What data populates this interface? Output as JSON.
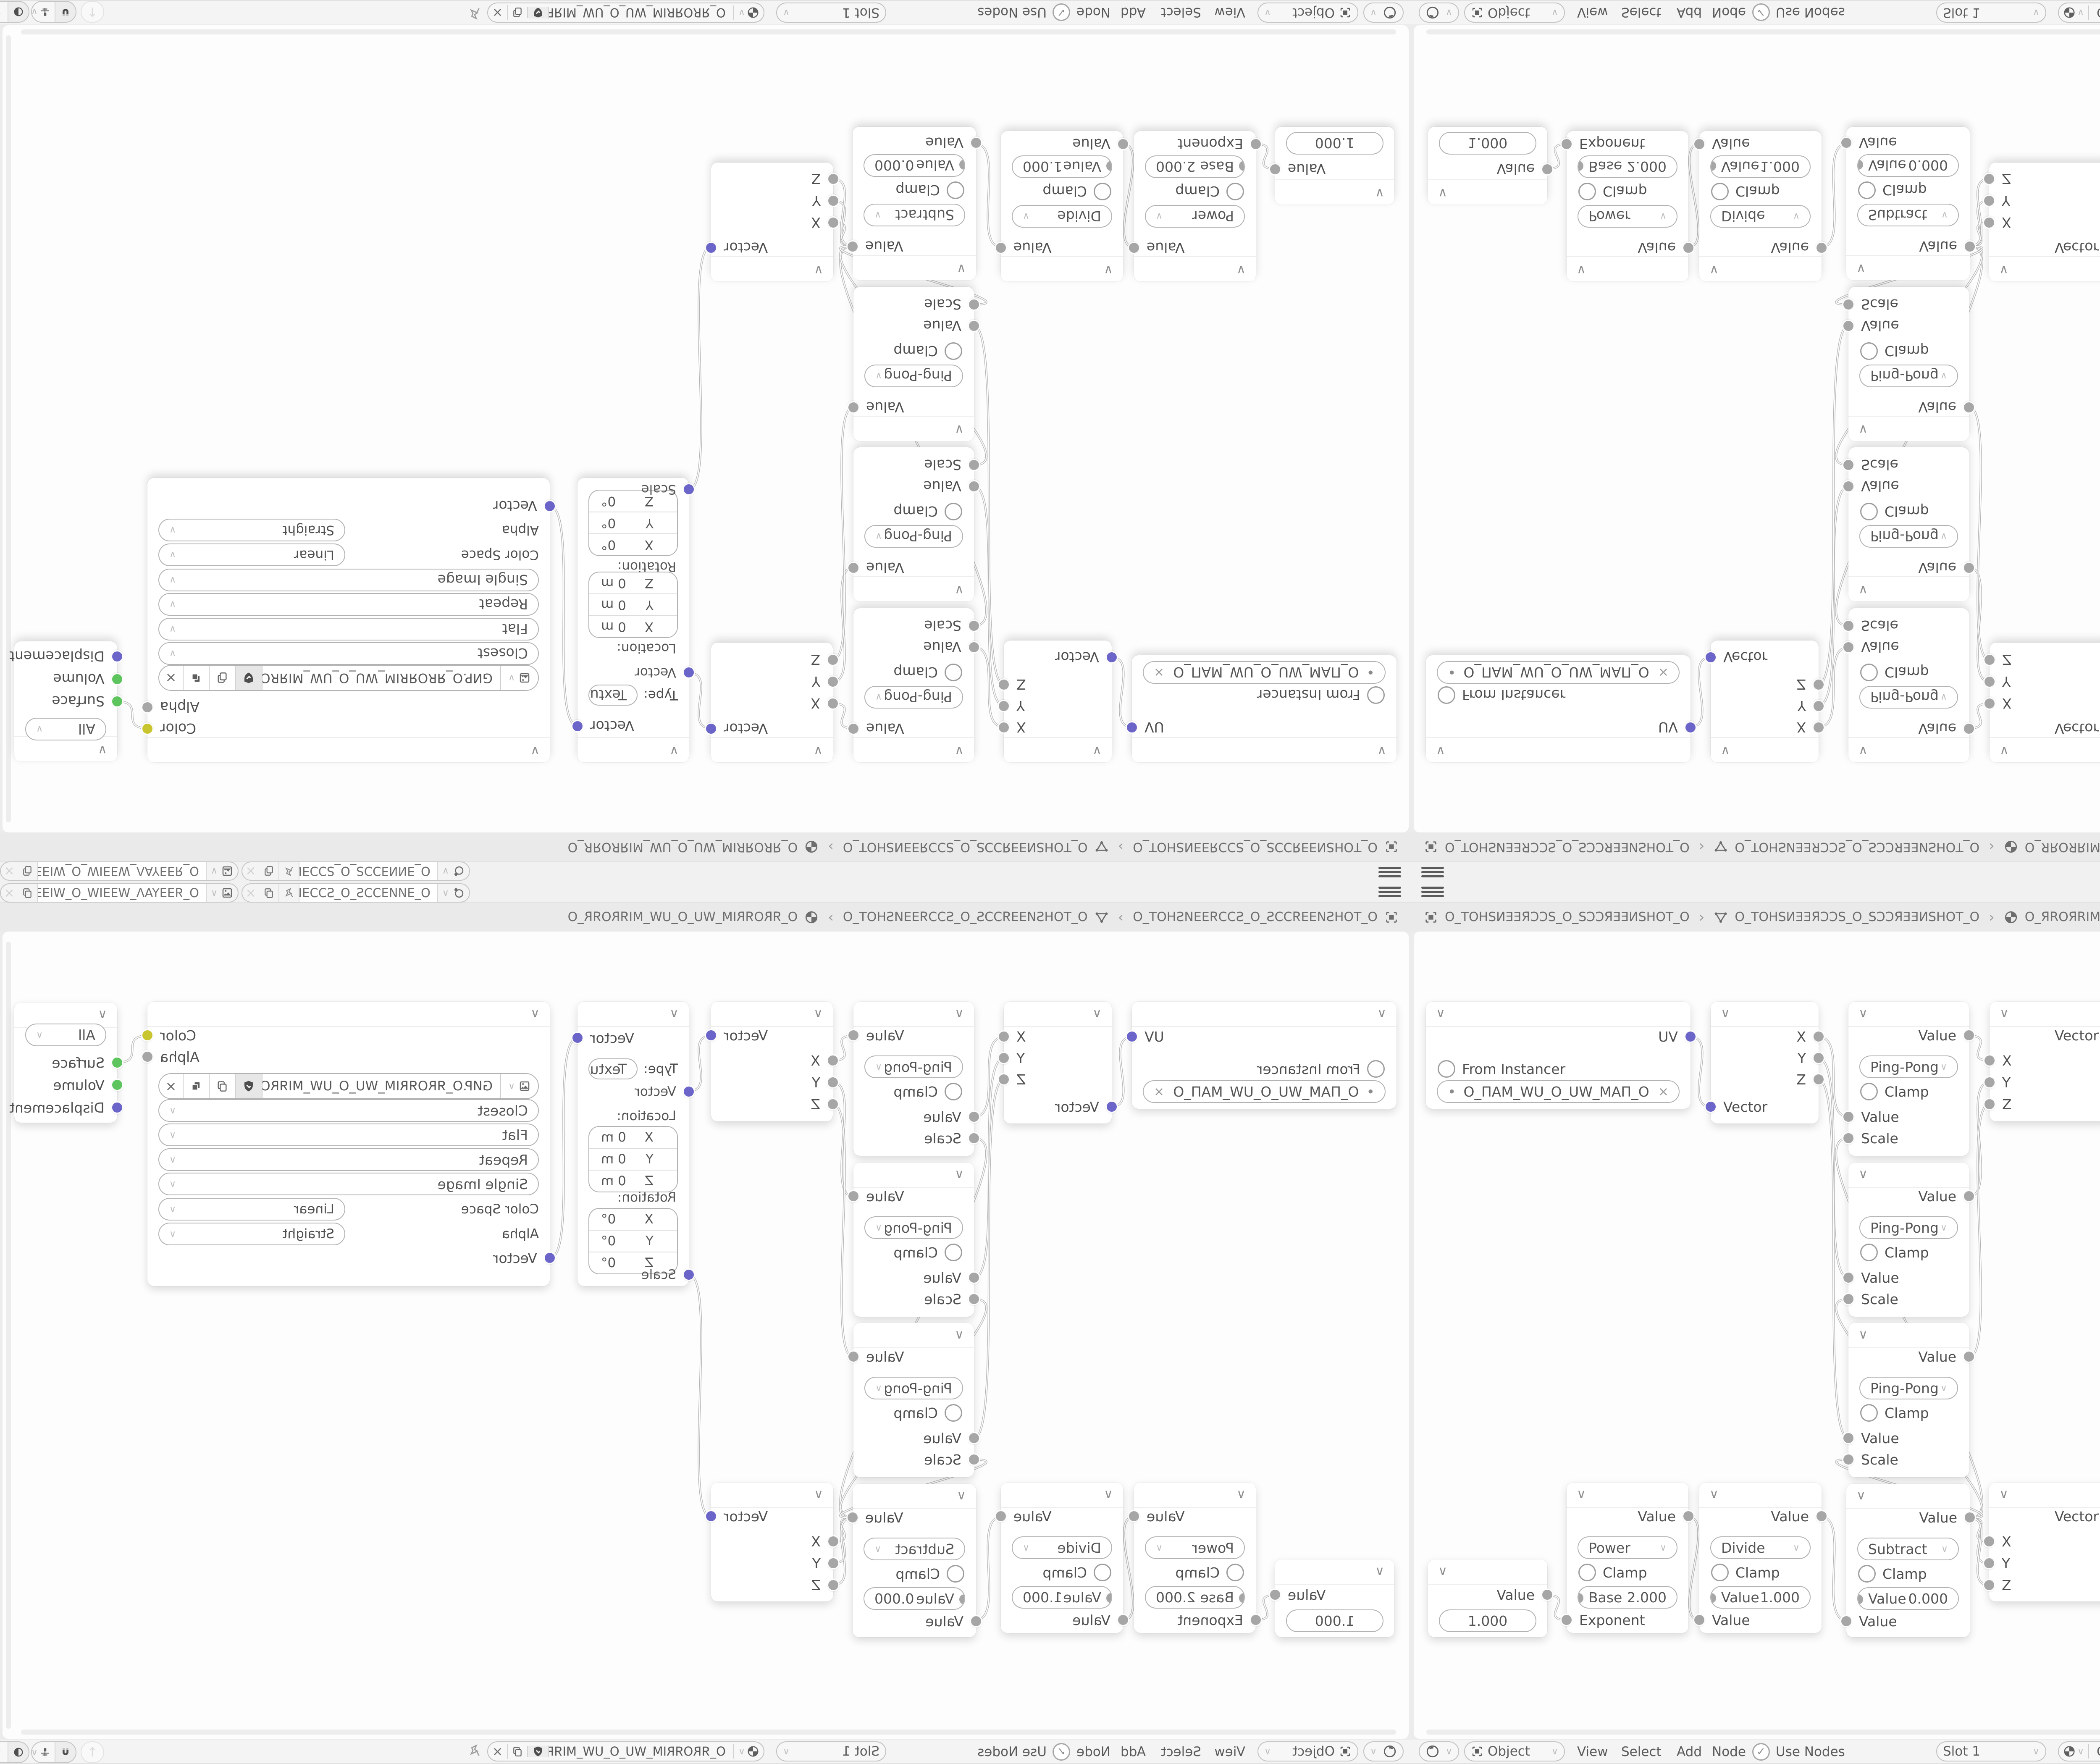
{
  "icons": {
    "chevron": "∨",
    "dropdown": "∨",
    "separator": "›",
    "close": "×",
    "check": "✓",
    "dot": "•",
    "up_arrow": "↑"
  },
  "topbar": {
    "scene_field": "O_ƎИИƎƆƆS_O_SƆƆƎИ...",
    "viewlayer_field": "O_ЯƎƎYAΛ_WƎƎIW_O_WIƎƎW_ΛAYƎƎЯ_O"
  },
  "breadcrumb": {
    "scene": "O_TOHSИƎƎЯƆƆS_O_SƆƆЯƎƎИSHOT_O",
    "object": "O_TOHSИƎƎЯƆƆS_O_SƆƆЯƎƎИSHOT_O",
    "material": "O_ЯROЯRIM_WU_O_UW_MIЯROЯR_O"
  },
  "nodes": {
    "uvmap": {
      "uv": "UV",
      "from_instancer": "From Instancer",
      "map_name": "O_ПAM_WU_O_UW_MAП_O"
    },
    "separate": {
      "x": "X",
      "y": "Y",
      "z": "Z",
      "vector": "Vector"
    },
    "pingpong": {
      "value": "Value",
      "op": "Ping-Pong",
      "clamp": "Clamp",
      "value_in": "Value",
      "scale": "Scale"
    },
    "combine": {
      "vector": "Vector",
      "x": "X",
      "y": "Y",
      "z": "Z"
    },
    "mapping": {
      "vector": "Vector",
      "type": "Type:",
      "type_value": "Texture",
      "vector_in": "Vector",
      "location": "Location:",
      "rotation": "Rotation:",
      "x": "X",
      "y": "Y",
      "z": "Z",
      "meters": "0 m",
      "degrees": "0°",
      "scale": "Scale"
    },
    "image_texture": {
      "color": "Color",
      "alpha": "Alpha",
      "file": "GИP.O_ЯROЯRIM_WU_O_UW_MIЯROЯR_O.PNG",
      "interpolation": "Closest",
      "projection": "Flat",
      "extension": "Repeat",
      "source": "Single Image",
      "color_space": "Color Space",
      "color_space_value": "Linear",
      "alpha_label": "Alpha",
      "alpha_value": "Straight",
      "vector": "Vector"
    },
    "output": {
      "target": "All",
      "surface": "Surface",
      "volume": "Volume",
      "displacement": "Displacement"
    },
    "value_node": {
      "value": "Value",
      "number": "1.000"
    },
    "power": {
      "value": "Value",
      "op": "Power",
      "clamp": "Clamp",
      "field_label": "Base",
      "field_value": "2.000",
      "input": "Exponent"
    },
    "divide": {
      "value": "Value",
      "op": "Divide",
      "clamp": "Clamp",
      "field_label": "Value",
      "field_value": "1.000",
      "input": "Value"
    },
    "subtract": {
      "value": "Value",
      "op": "Subtract",
      "clamp": "Clamp",
      "field_label": "Value",
      "field_value": "0.000",
      "input": "Value"
    }
  },
  "header": {
    "mode": "Object",
    "view": "View",
    "select": "Select",
    "add": "Add",
    "node": "Node",
    "use_nodes": "Use Nodes",
    "slot": "Slot 1",
    "material": "O_ЯROЯRIM_WU_O_UW_MIЯROЯR_O"
  },
  "colors": {
    "socket_vector": "#6c65c9",
    "socket_value": "#a6a6a6",
    "socket_color": "#c8c52f",
    "socket_shader": "#5ec45e",
    "wire": "#b3b3b3",
    "canvas": "#fdfdfd"
  },
  "links": [
    [
      665,
      369,
      713,
      535
    ],
    [
      970,
      369,
      1041,
      559
    ],
    [
      970,
      420,
      1041,
      942
    ],
    [
      970,
      471,
      1041,
      1324
    ],
    [
      1328,
      366,
      1377,
      425
    ],
    [
      1328,
      749,
      1377,
      477
    ],
    [
      1328,
      1131,
      1377,
      529
    ],
    [
      1667,
      366,
      1720,
      498
    ],
    [
      1985,
      372,
      2051,
      895
    ],
    [
      3009,
      366,
      3081,
      430
    ],
    [
      324,
      1698,
      370,
      1757
    ],
    [
      660,
      1512,
      686,
      1757
    ],
    [
      977,
      1512,
      1036,
      1757
    ],
    [
      1330,
      1514,
      1376,
      1570
    ],
    [
      1330,
      1514,
      1376,
      1622
    ],
    [
      1330,
      1514,
      1376,
      1674
    ],
    [
      1330,
      1514,
      1041,
      610
    ],
    [
      1330,
      1514,
      1041,
      993
    ],
    [
      1330,
      1514,
      1041,
      1375
    ],
    [
      1667,
      1512,
      1720,
      935
    ]
  ]
}
